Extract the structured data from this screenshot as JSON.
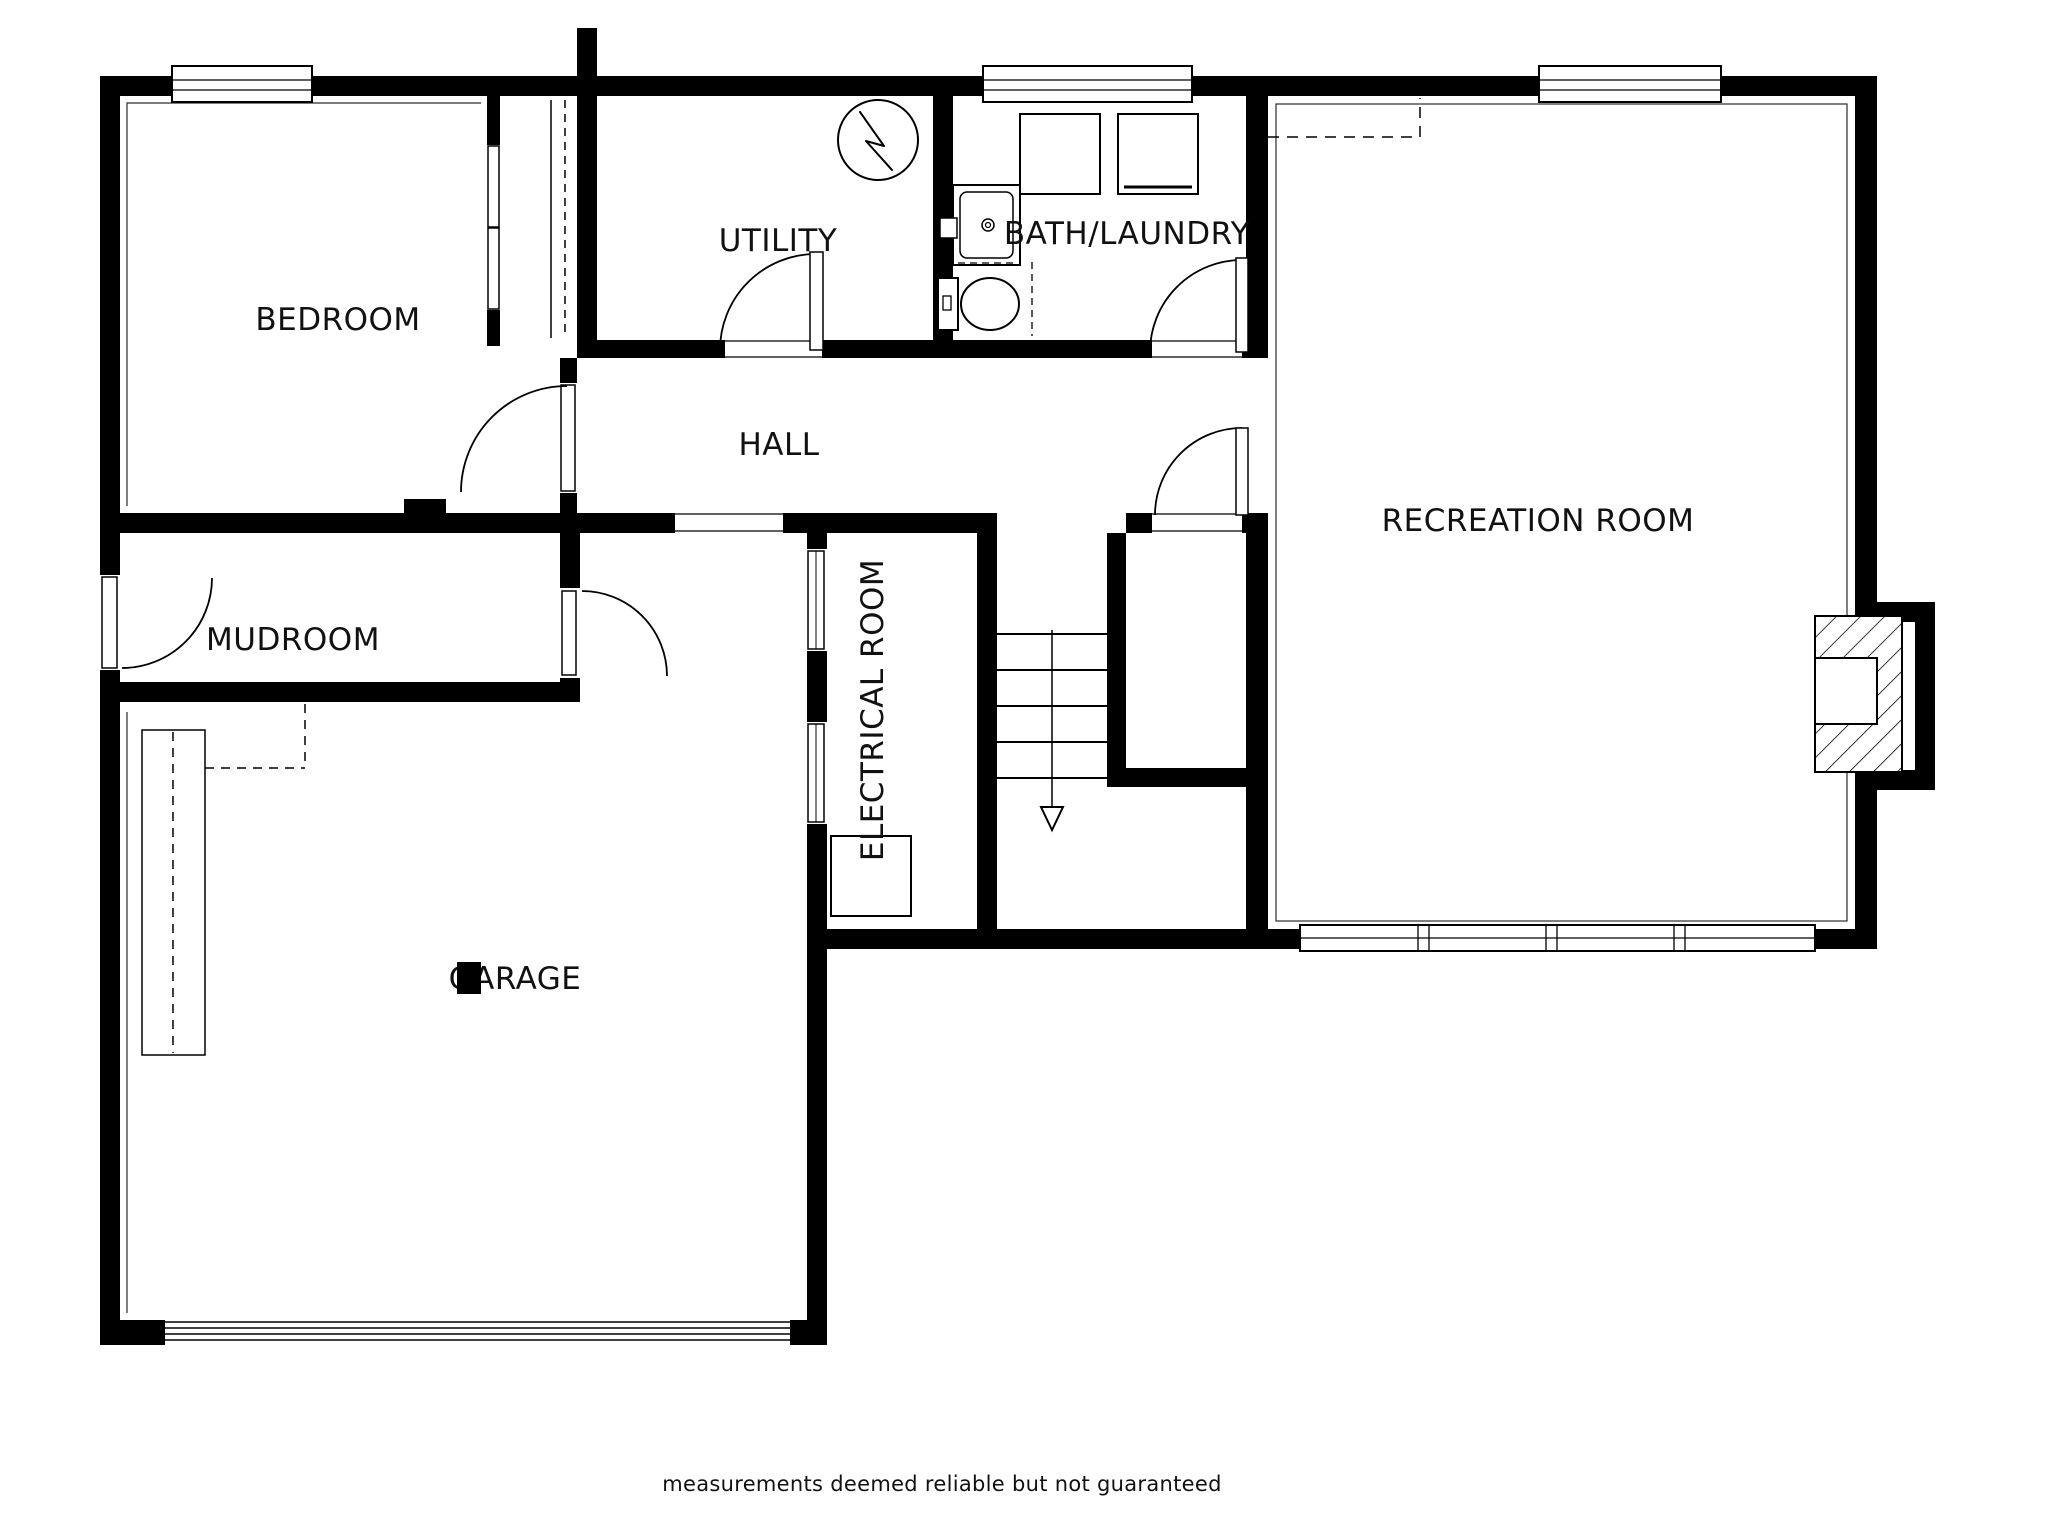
{
  "canvas": {
    "background_color": "#ffffff",
    "wall_color": "#000000",
    "text_color": "#111111"
  },
  "rooms": {
    "bedroom": "BEDROOM",
    "utility": "UTILITY",
    "bath_laundry": "BATH/LAUNDRY",
    "hall": "HALL",
    "recreation": "RECREATION ROOM",
    "mudroom": "MUDROOM",
    "electrical": "ELECTRICAL ROOM",
    "garage": "GARAGE"
  },
  "footer": {
    "disclaimer": "measurements deemed reliable but not guaranteed"
  },
  "symbols": {
    "water_heater": "water-heater-icon",
    "washer": "washer-icon",
    "dryer": "dryer-icon",
    "sink": "sink-vanity-icon",
    "toilet": "toilet-icon",
    "fireplace": "fireplace-hatch-icon",
    "stairs_down": "stairs-down-arrow-icon",
    "door_swing": "door-swing-icon",
    "window": "window-icon",
    "garage_door": "garage-door-icon",
    "electrical_panel": "electrical-panel-icon",
    "column": "column-post-icon",
    "closet_rod": "closet-rod-dashed-icon"
  }
}
